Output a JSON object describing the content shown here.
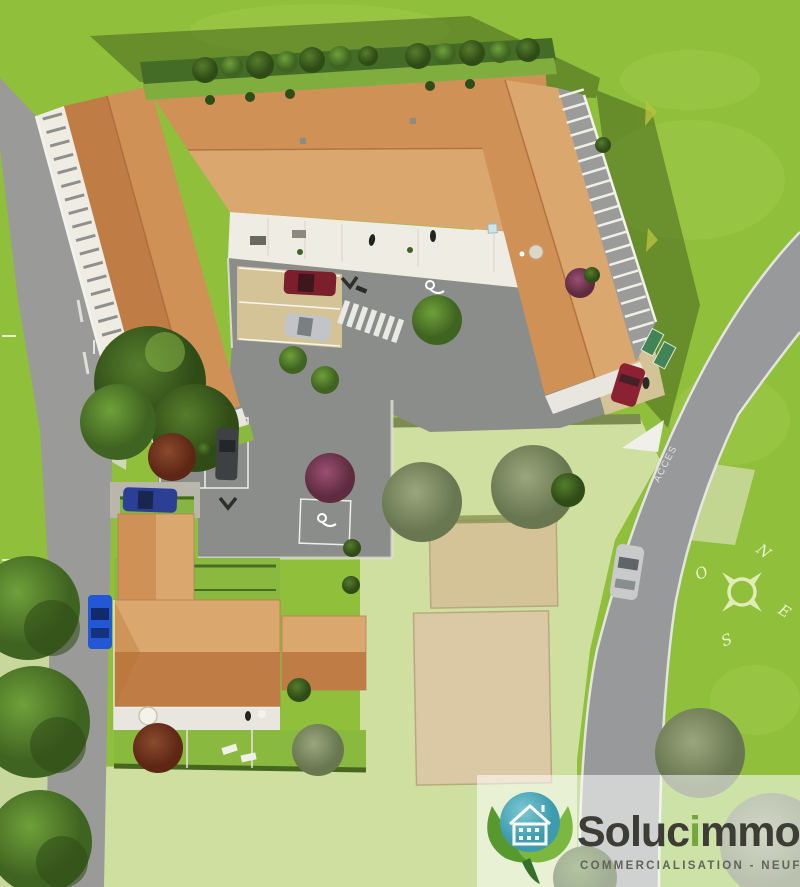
{
  "road": {
    "access_label": "ACCES"
  },
  "compass": {
    "north": "N",
    "west": "O",
    "east": "E",
    "south": "S"
  },
  "logo": {
    "name_prefix": "Soluc",
    "name_accent": "i",
    "name_suffix": "mmo",
    "tagline": "COMMERCIALISATION - NEUF"
  },
  "colors": {
    "grass": "#90bf3c",
    "grass_pale": "#cfdf9f",
    "road": "#98999a",
    "road_left": "#9a9a98",
    "asphalt": "#8b8d8b",
    "tan": "#d5c398",
    "roof_dark": "#c07c45",
    "roof_mid": "#cf9156",
    "roof_light": "#daa76f",
    "facade": "#efece4",
    "balcony_gray": "#9b9c99",
    "hedge": "#446c26",
    "shadow": "#2f4a14",
    "marking_white": "#f0efe9",
    "tree_dark": "#33511a",
    "tree_mid": "#5d8c2e",
    "tree_olive": "#8b9a72",
    "tree_red": "#7c3a22",
    "tree_purple": "#8e3a62",
    "car_red": "#7c1f2d",
    "car_silver": "#c2c5c7",
    "car_dark": "#3d4144",
    "car_blue_dark": "#2b3f94",
    "car_blue": "#2257d6",
    "car_red_access": "#8c2133",
    "brand_teal": "#47a5b5",
    "brand_leaf_dark": "#57982f",
    "brand_leaf_light": "#7cb83f",
    "brand_text": "#3d3d36",
    "brand_accent": "#74a63c",
    "tagline_text": "#63635a",
    "compass_text": "#edf3cc"
  }
}
